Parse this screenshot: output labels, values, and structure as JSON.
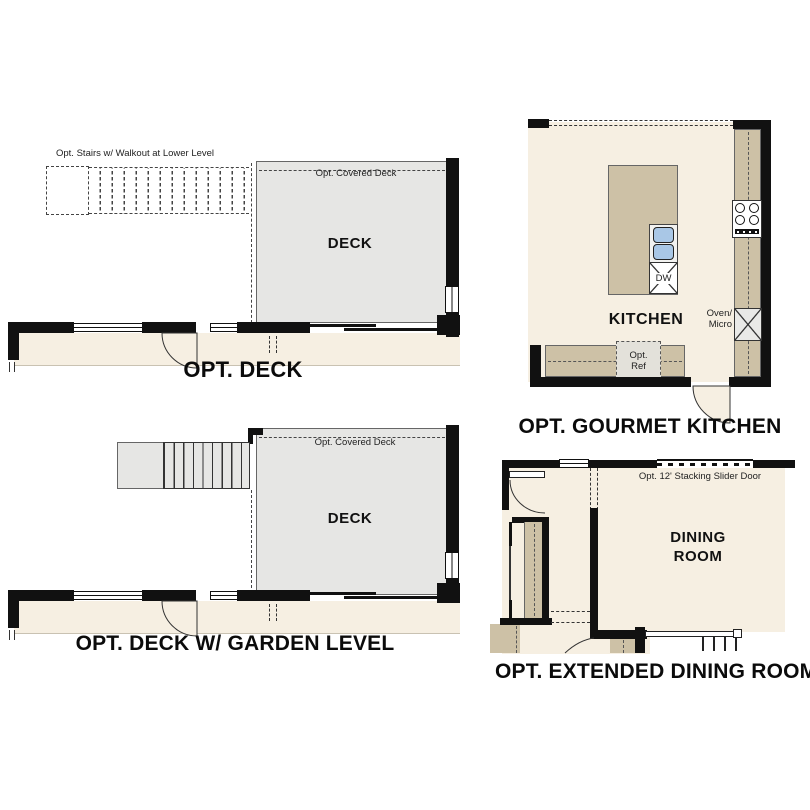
{
  "colors": {
    "floor": "#f6efe2",
    "counter": "#cdc1a6",
    "deck": "#e6e6e4",
    "wall": "#111111",
    "sink": "#a9c7e6",
    "boxgrey": "#e9e9e7",
    "refgrey": "#e3e1da",
    "line": "#555555"
  },
  "panels": {
    "deck": {
      "caption": "OPT. DECK",
      "stairs_label": "Opt. Stairs w/ Walkout at Lower Level",
      "covered_deck_label": "Opt. Covered Deck",
      "room_label": "DECK"
    },
    "deck_garden": {
      "caption": "OPT. DECK W/ GARDEN LEVEL",
      "covered_deck_label": "Opt. Covered Deck",
      "room_label": "DECK"
    },
    "gourmet_kitchen": {
      "caption": "OPT. GOURMET KITCHEN",
      "room_label": "KITCHEN",
      "dw_label": "DW",
      "ref_label_line1": "Opt.",
      "ref_label_line2": "Ref",
      "oven_label_line1": "Oven/",
      "oven_label_line2": "Micro"
    },
    "extended_dining": {
      "caption": "OPT. EXTENDED DINING ROOM",
      "room_label_line1": "DINING",
      "room_label_line2": "ROOM",
      "slider_label": "Opt. 12' Stacking Slider Door"
    }
  }
}
